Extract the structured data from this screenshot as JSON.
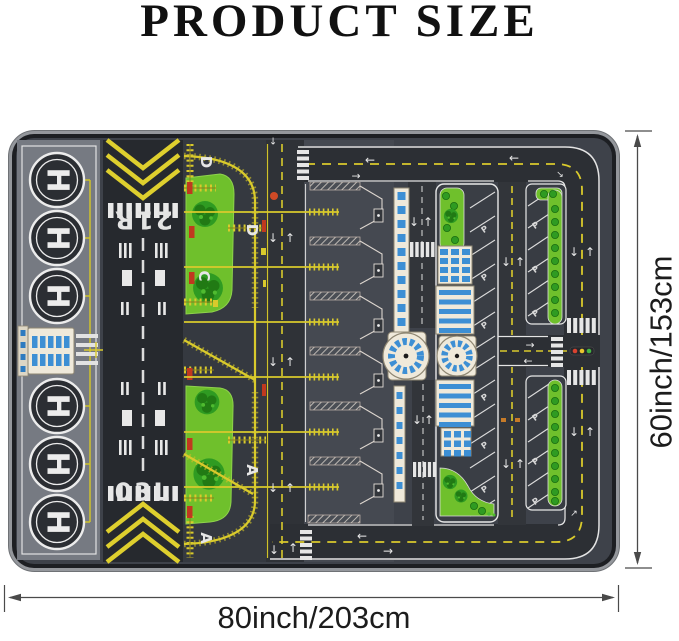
{
  "title": "PRODUCT SIZE",
  "dimensions": {
    "width_label": "80inch/203cm",
    "height_label": "60inch/153cm"
  },
  "mat": {
    "runway": {
      "top_designator": "21R",
      "bottom_designator": "03L"
    },
    "helipad_letter": "H",
    "helipad_count": 6,
    "taxiway_labels": {
      "d1": "D",
      "d2": "D",
      "c": "C",
      "a1": "A",
      "a2": "A"
    },
    "parking_letter": "P",
    "symbols": {
      "up": "↑",
      "down": "↓",
      "left": "←",
      "right": "→",
      "ne": "↗",
      "sw": "↙",
      "se": "↘"
    },
    "colors": {
      "mat_edge": "#94979c",
      "asphalt": "#3e424a",
      "runway": "#26292e",
      "marking_yellow": "#d9ca2c",
      "marking_white": "#e6e6e6",
      "grass": "#6fc02c",
      "tree": "#2f9b22",
      "terminal_tan": "#efe9da",
      "terminal_blue": "#3d8fd4",
      "sign_red": "#c0391f",
      "signal_red": "#d94230",
      "signal_amber": "#e9c52e",
      "signal_green": "#43b543"
    }
  }
}
